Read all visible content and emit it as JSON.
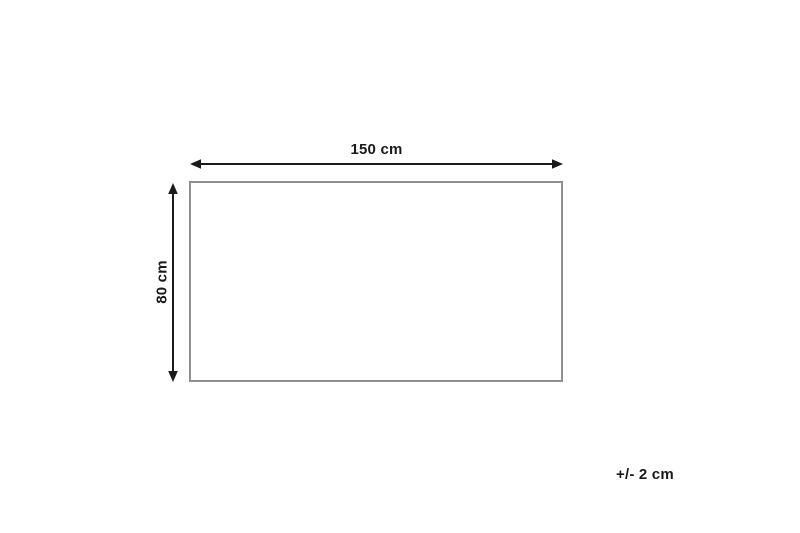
{
  "diagram": {
    "width_label": "150 cm",
    "height_label": "80 cm",
    "tolerance_label": "+/- 2 cm",
    "colors": {
      "arrow": "#1a1a1a",
      "text": "#1a1a1a",
      "rectangle_border": "#8e8e8e",
      "background": "#ffffff"
    }
  }
}
